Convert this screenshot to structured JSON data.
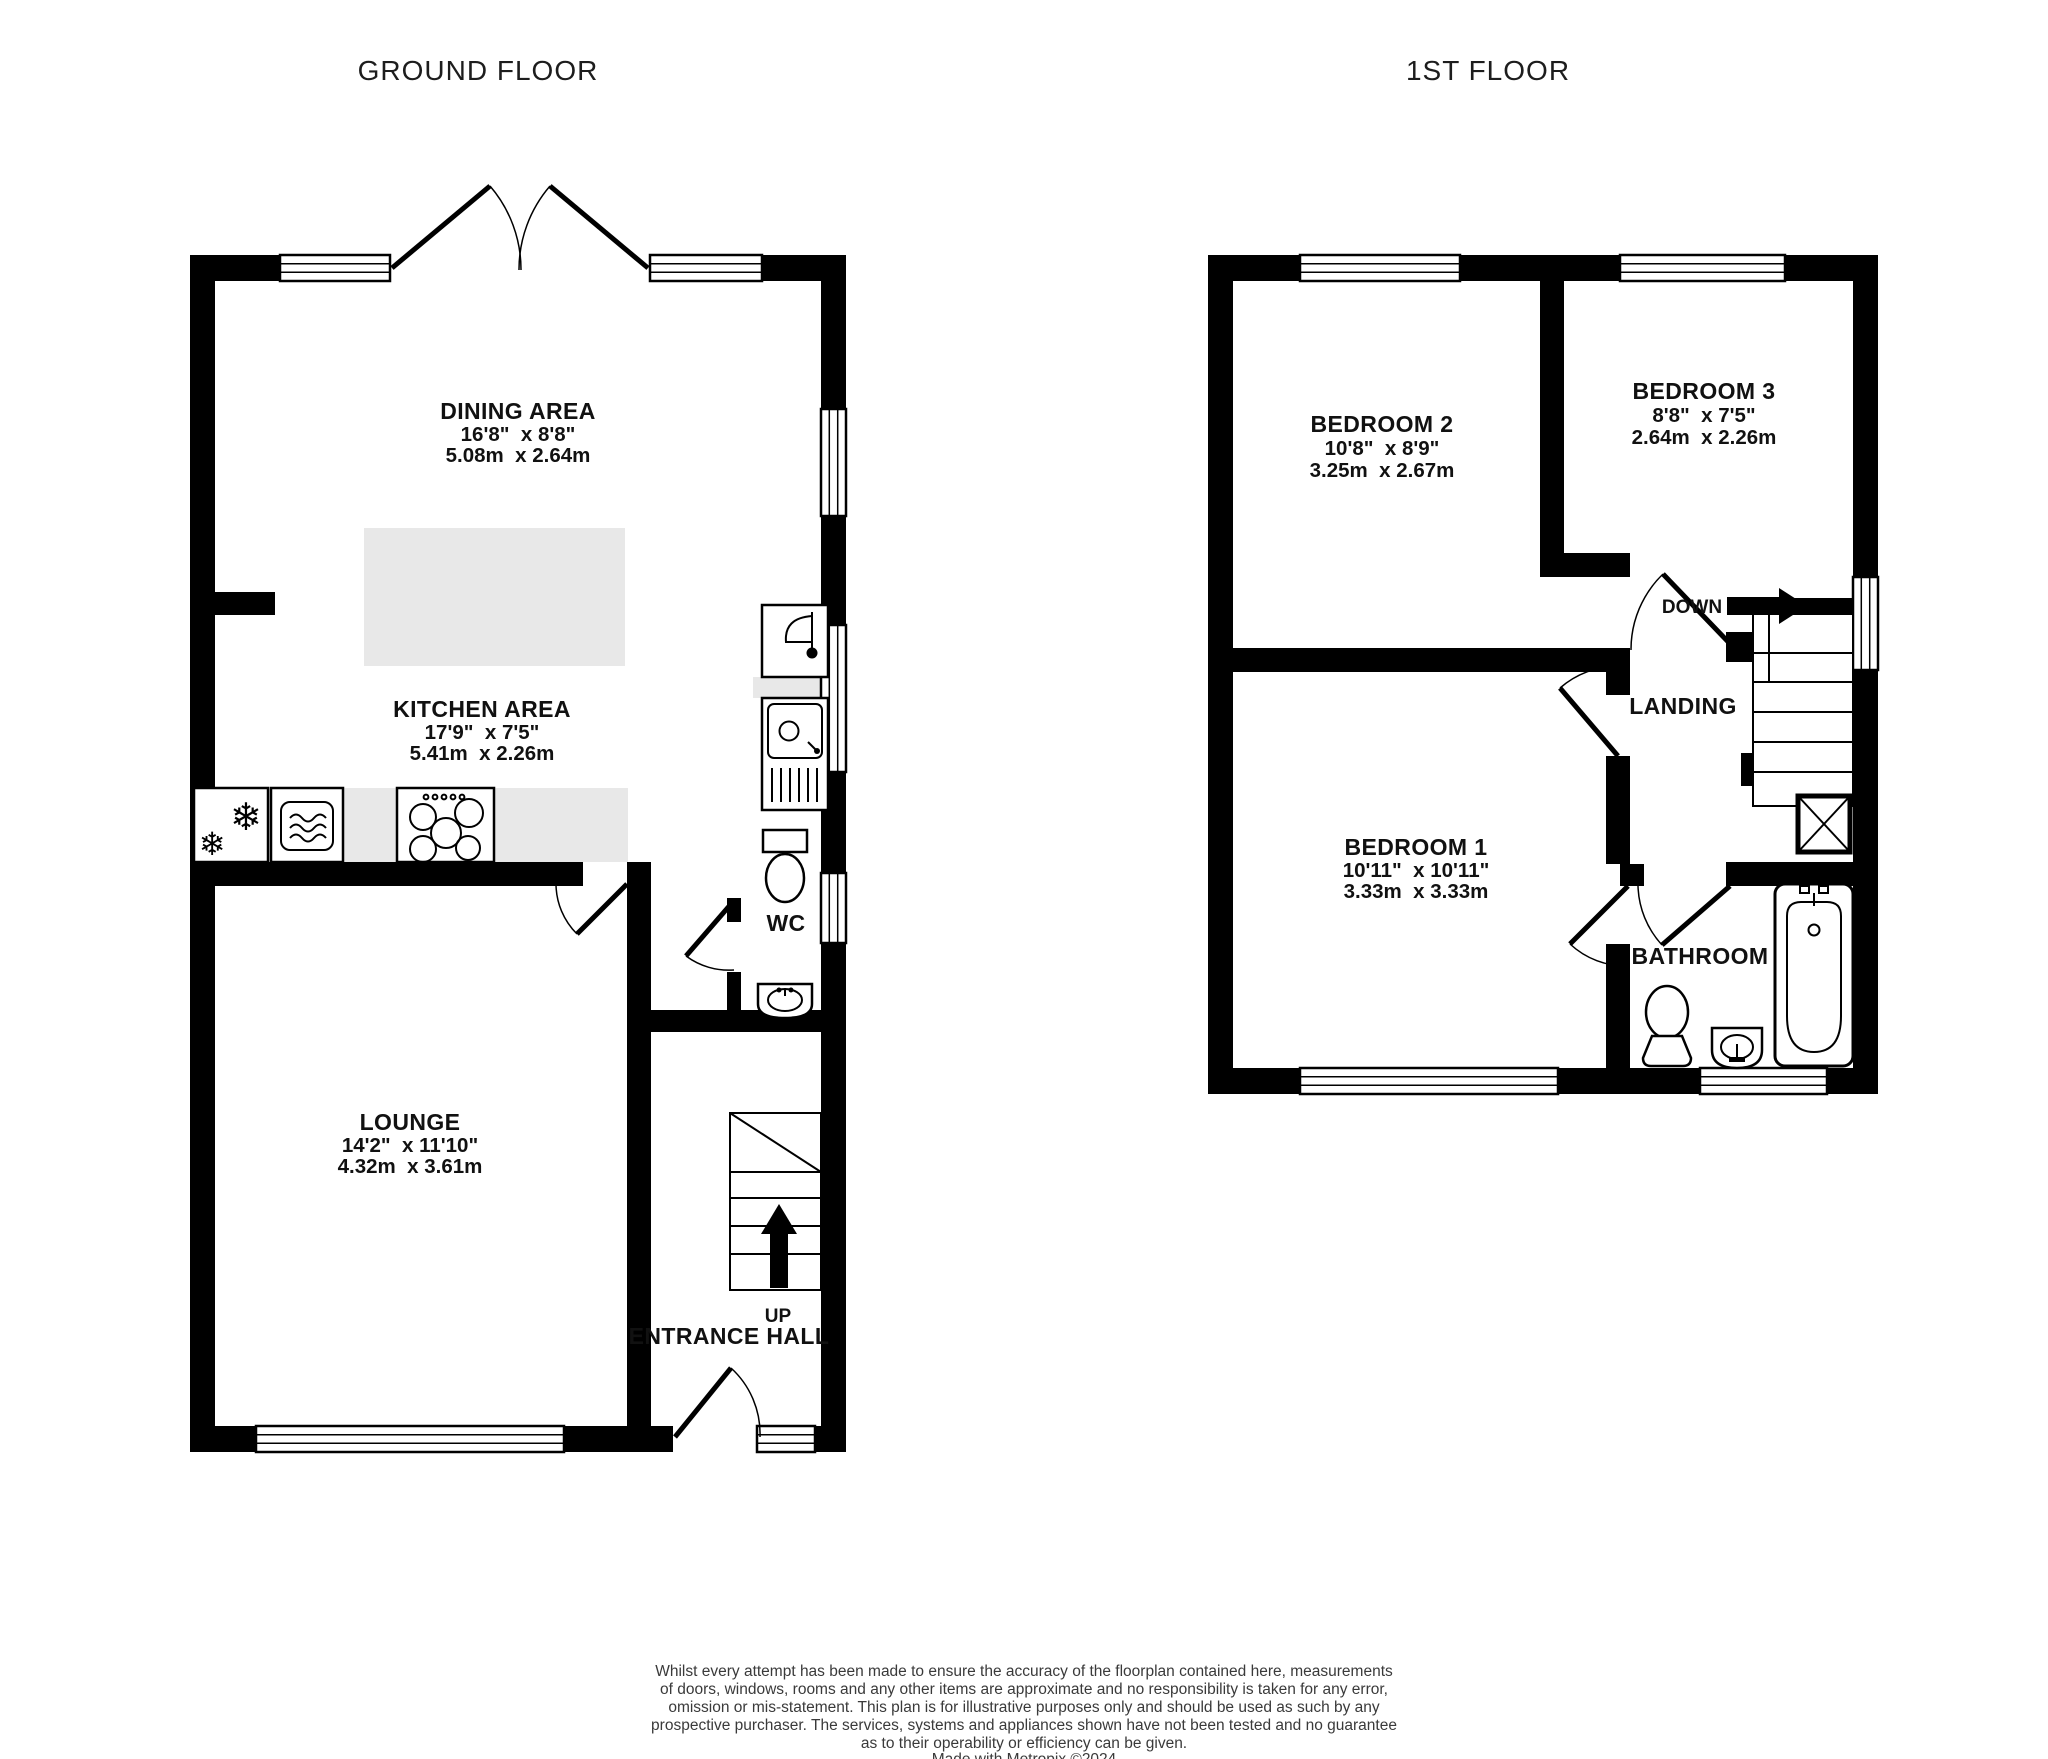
{
  "titles": {
    "ground": "GROUND FLOOR",
    "first": "1ST FLOOR"
  },
  "ground_floor": {
    "dining": {
      "name": "DINING AREA",
      "imperial": "16'8\"  x 8'8\"",
      "metric": "5.08m  x 2.64m"
    },
    "kitchen": {
      "name": "KITCHEN AREA",
      "imperial": "17'9\"  x 7'5\"",
      "metric": "5.41m  x 2.26m"
    },
    "lounge": {
      "name": "LOUNGE",
      "imperial": "14'2\"  x 11'10\"",
      "metric": "4.32m  x 3.61m"
    },
    "wc": {
      "name": "WC"
    },
    "entrance_hall": {
      "name": "ENTRANCE HALL",
      "stairs_label": "UP"
    }
  },
  "first_floor": {
    "bedroom1": {
      "name": "BEDROOM 1",
      "imperial": "10'11\"  x 10'11\"",
      "metric": "3.33m  x 3.33m"
    },
    "bedroom2": {
      "name": "BEDROOM 2",
      "imperial": "10'8\"  x 8'9\"",
      "metric": "3.25m  x 2.67m"
    },
    "bedroom3": {
      "name": "BEDROOM 3",
      "imperial": "8'8\"  x 7'5\"",
      "metric": "2.64m  x 2.26m"
    },
    "landing": {
      "name": "LANDING",
      "stairs_label": "DOWN"
    },
    "bathroom": {
      "name": "BATHROOM"
    }
  },
  "footer": {
    "lines": [
      "Whilst every attempt has been made to ensure the accuracy of the floorplan contained here, measurements",
      "of doors, windows, rooms and any other items are approximate and no responsibility is taken for any error,",
      "omission or mis-statement. This plan is for illustrative purposes only and should be used as such by any",
      "prospective purchaser. The services, systems and appliances shown have not been tested and no guarantee",
      "as to their operability or efficiency can be given."
    ],
    "credit": "Made with Metropix ©2024"
  }
}
